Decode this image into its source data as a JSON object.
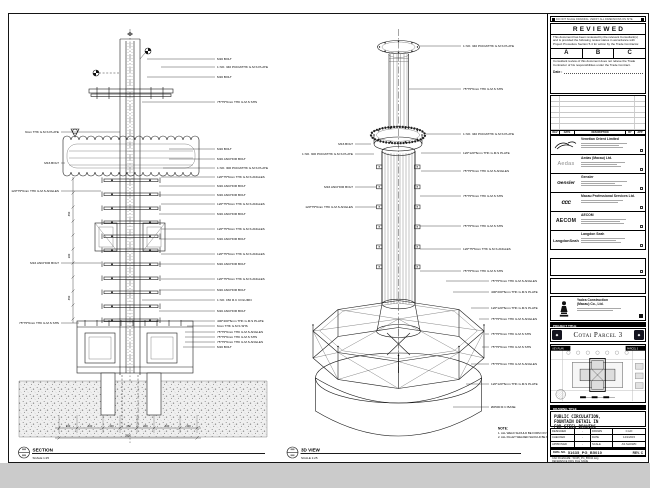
{
  "colors": {
    "paper": "#ffffff",
    "ink": "#1a1a1a",
    "outside_bg": "#cbcbcb"
  },
  "stamp": {
    "header": "DO NOT SCALE DRAWING. VERIFY ALL DIMENSIONS ON SITE.",
    "title": "REVIEWED",
    "para1": "This document has been reviewed by the relevant Consultant(s) and is provided the following review status in accordance with Project Procedure Section 5.4 for action by the Trade Contractor.",
    "grades": [
      "A",
      "B",
      "C"
    ],
    "para2": "Consultant review of this document does not relieve the Trade Contractor of his responsibilities under the Trade Contract.",
    "date_label": "Date :"
  },
  "rev_table": {
    "headers": [
      "REV",
      "DATE",
      "DESCRIPTION",
      "BY",
      "APP"
    ]
  },
  "companies": [
    {
      "logo": "Venetian",
      "name": "Venetian Orient Limited"
    },
    {
      "logo": "Aedas",
      "name": "Aedas (Macau) Ltd."
    },
    {
      "logo": "Gensler",
      "name": "Gensler"
    },
    {
      "logo": "ccc",
      "name": "Macau Professional Services Ltd."
    },
    {
      "logo": "AECOM",
      "name": "AECOM"
    },
    {
      "logo": "LangdonSeah",
      "name": "Langdon Seah"
    }
  ],
  "contractor": {
    "name_line1": "Yadea Construction",
    "name_line2": "(Macau) Co., Ltd."
  },
  "project": {
    "label": "PROJECT TITLE",
    "name": "Cotai Parcel 3"
  },
  "keyplan": {
    "label": "KEY PLAN",
    "parcel": "PARCEL 3"
  },
  "title_block": {
    "label": "DRAWING TITLE",
    "line1": "PUBLIC CIRCULATION,",
    "line2": "FOUNTAIN DETAIL IN",
    "line3": "FOR STEEL DRAWING",
    "designed_label": "DESIGNED",
    "designed": "-",
    "drawn_label": "DRAWN",
    "drawn": "C.HO",
    "checked_label": "CHECKED",
    "checked": "-",
    "date_label": "DATE",
    "date": "14/1/2015",
    "approved_label": "APPROVED",
    "approved": "-",
    "scale_label": "SCALE",
    "scale": "AS SHOWN",
    "dwg_label": "DWG. NO.",
    "dwg_no": "51635_PG_B5010",
    "rev": "REV. C",
    "cad_label": "CAD FILENAME :",
    "cad_value": "51635_PG_B5010.dwg",
    "ref_label": "REFERENCE DWG FILE NAME"
  },
  "views": {
    "section": {
      "name": "SECTION",
      "scale": "SCALE 1:25"
    },
    "iso": {
      "name": "3D VIEW",
      "scale": "SCALE 1:25"
    }
  },
  "note": {
    "label": "NOTE:",
    "line1": "1. ALL WELD SHOULD BE FORM ON SITE.",
    "line2": "2. ALL FILLET WELDED SHOULD BE 6mm THK."
  },
  "dims": {
    "chain": [
      "300",
      "600",
      "300",
      "450",
      "300",
      "600",
      "300"
    ],
    "total": "2850",
    "v": [
      "450",
      "300",
      "450"
    ]
  },
  "callouts": {
    "sec_r": [
      "M16 BOLT",
      "1 NO. 340 PCDx6THK G.M.S PLATE",
      "M16 BOLT",
      "75*75*6mm THK G.M.S SHS",
      "M16 BOLT",
      "M16 ANCHOR BOLT",
      "1 NO. 300 PCDx6THK G.M.S PLATE",
      "120*75*6mm THK G.M.S ANGLES",
      "M16 ANCHOR BOLT",
      "M16 ANCHOR BOLT",
      "120*75*6mm THK G.M.S ANGLES",
      "M16 ANCHOR BOLT",
      "120*75*6mm THK G.M.S ANGLES",
      "M16 ANCHOR BOLT",
      "120*75*6mm THK G.M.S ANGLES",
      "M16 ANCHOR BOLT",
      "120*75*6mm THK G.M.S ANGLES",
      "M16 ANCHOR BOLT",
      "1 NO. 150 R.C COLUMN",
      "M16 ANCHOR BOLT",
      "400*400*6mm THK G.M.S PLATE",
      "6mm THK G.M.S SHS",
      "75*75*6mm THK G.M.S ANGLES",
      "75*75*6mm THK G.M.S SHS",
      "75*75*6mm THK G.M.S ANGLES",
      "M16 BOLT"
    ],
    "sec_l": [
      "6mm THK G.M.S PLATE",
      "M16 BOLT",
      "120*75*6mm THK G.M.S ANGLES",
      "M16 ANCHOR BOLT",
      "75*75*6mm THK G.M.S SHS"
    ],
    "iso_r": [
      "1 NO. 340 PCDx6THK G.M.S PLATE",
      "75*75*6mm THK G.M.S SHS",
      "1 NO. 340 PCDx6THK G.M.S PLATE",
      "120*120*6mm THK G.M.S PLATE",
      "75*75*6mm THK G.M.S ANGLES",
      "75*75*6mm THK G.M.S SHS",
      "75*75*6mm THK G.M.S SHS",
      "120*75*6mm THK G.M.S ANGLES",
      "75*75*6mm THK G.M.S SHS",
      "75*75*6mm THK G.M.S ANGLES",
      "400*200*6mm THK G.M.S PLATE",
      "120*120*6mm THK G.M.S PLATE",
      "75*75*6mm THK G.M.S ANGLES",
      "75*75*6mm THK G.M.S SHS",
      "75*75*6mm THK G.M.S SHS",
      "75*75*6mm THK G.M.S ANGLES",
      "120*120*6mm THK G.M.S PLATE",
      "Ø2500 R.C BASE"
    ],
    "iso_l": [
      "M16 BOLT",
      "1 NO. 300 PCDx6THK G.M.S PLATE",
      "M16 ANCHOR BOLT",
      "120*75*6mm THK G.M.S ANGLES"
    ]
  }
}
